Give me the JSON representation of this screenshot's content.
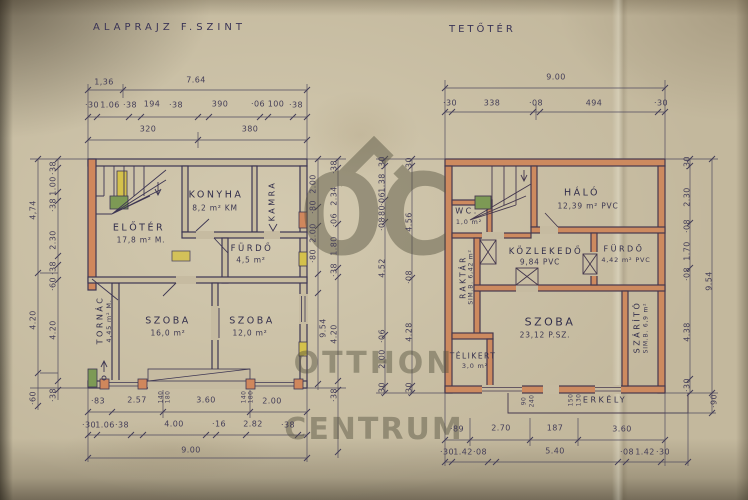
{
  "titles": {
    "left": "ALAPRAJZ F.SZINT",
    "right": "TETŐTÉR"
  },
  "watermark": {
    "monogram": "OC",
    "line1": "OTTHON",
    "line2": "CENTRUM"
  },
  "colors": {
    "paper": "#c3b89d",
    "ink": "#3d3653",
    "wall_orange": "#d0875c",
    "accent_yellow": "#d4c14b",
    "accent_green": "#7d9a55",
    "watermark_gray": "#55523f"
  },
  "left_plan": {
    "rooms": {
      "eloter": {
        "name": "ELŐTÉR",
        "area": "17,8 m² M."
      },
      "konyha": {
        "name": "KONYHA",
        "area": "8,2 m² KM"
      },
      "kamra": {
        "name": "KAMRA"
      },
      "furdo": {
        "name": "FÜRDŐ",
        "area": "4,5 m²"
      },
      "szoba1": {
        "name": "SZOBA",
        "area": "16,0 m²"
      },
      "szoba2": {
        "name": "SZOBA",
        "area": "12,0 m²"
      },
      "tornac": {
        "name": "TORNÁC",
        "area": "4,45 m² M."
      }
    },
    "dims": {
      "top1": [
        "1,36",
        "7.64"
      ],
      "top2": [
        "·30",
        "1.06",
        "·38",
        "194",
        "·38",
        "390",
        "·06",
        "100",
        "·38"
      ],
      "top3": [
        "320",
        "380"
      ],
      "bottom1": [
        "·83",
        "2.57",
        "3.60",
        "2.00"
      ],
      "bottom1_small": [
        "140",
        "180",
        "140",
        "180"
      ],
      "bottom2": [
        "·30",
        "1.06",
        "·38",
        "4.00",
        "·16",
        "2.82",
        "·38"
      ],
      "bottom3": "9.00",
      "left_outer": [
        "4,74",
        "4.20",
        "·60"
      ],
      "left_inner": [
        "·38",
        "1.00",
        "·38",
        "2.30",
        "·38",
        "·60",
        "4.20",
        "·38"
      ],
      "right_inner": [
        "2.00",
        "·80",
        "2.00",
        "·80",
        "9.54"
      ],
      "right_outer": [
        "·38",
        "2.34",
        "·06",
        "1.80",
        "·38",
        "4.20",
        "·38"
      ]
    }
  },
  "right_plan": {
    "rooms": {
      "halo": {
        "name": "HÁLÓ",
        "area": "12,39 m² PVC"
      },
      "wc": {
        "name": "WC.",
        "area": "1,0 m²"
      },
      "kozlekedo": {
        "name": "KÖZLEKEDŐ",
        "area": "9,84 PVC"
      },
      "furdo": {
        "name": "FÜRDŐ",
        "area": "4,42 m² PVC"
      },
      "raktar": {
        "name": "RAKTÁR",
        "area": "SIM.B. 6,42 m²"
      },
      "szoba": {
        "name": "SZOBA",
        "area": "23,12 P.SZ."
      },
      "telikert": {
        "name": "TÉLIKERT",
        "area": "3,0 m²"
      },
      "szarito": {
        "name": "SZÁRÍTÓ",
        "area": "SIM.B. 6,9 m²"
      },
      "erkely": {
        "name": "ERKÉLY"
      }
    },
    "dims": {
      "top1": "9.00",
      "top2": [
        "·30",
        "338",
        "·08",
        "494",
        "·30"
      ],
      "bottom_small": [
        "90",
        "240",
        "150",
        "130"
      ],
      "bottom1": [
        "·89",
        "2.70",
        "187",
        "3.60"
      ],
      "bottom2": [
        "·30",
        "1.42",
        "·08",
        "5.40",
        "·08",
        "1.42",
        "·30"
      ],
      "left_inner": [
        "·30",
        "1.38",
        "·06",
        "·80",
        "·08",
        "4.52",
        "·06",
        "2.00",
        "·30"
      ],
      "left_outer": [
        "·30",
        "4.56",
        "·08",
        "4.28",
        "·30"
      ],
      "right_inner": [
        "·30",
        "2.30",
        "·08",
        "1.70",
        "·08",
        "4.38",
        "·30"
      ],
      "right_outer": [
        "9.54",
        "·90"
      ]
    }
  }
}
